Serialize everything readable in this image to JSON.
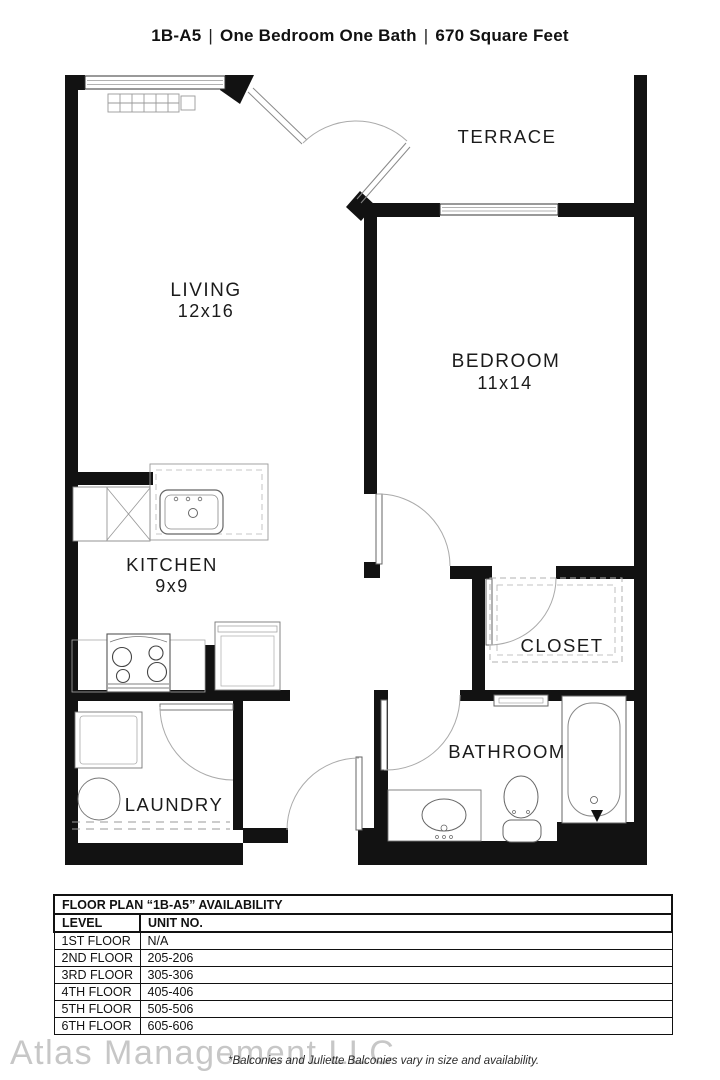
{
  "title": {
    "unit": "1B-A5",
    "separator": "|",
    "description": "One Bedroom One Bath",
    "area": "670 Square Feet"
  },
  "floorplan": {
    "rooms": {
      "living": {
        "label": "LIVING",
        "dims": "12x16"
      },
      "terrace": {
        "label": "TERRACE"
      },
      "bedroom": {
        "label": "BEDROOM",
        "dims": "11x14"
      },
      "kitchen": {
        "label": "KITCHEN",
        "dims": "9x9"
      },
      "closet": {
        "label": "CLOSET"
      },
      "bathroom": {
        "label": "BATHROOM"
      },
      "laundry": {
        "label": "LAUNDRY"
      }
    },
    "wall_color": "#121212",
    "fixture_line_color": "#777777"
  },
  "availability": {
    "table_title": "FLOOR PLAN “1B-A5” AVAILABILITY",
    "columns": {
      "level": "LEVEL",
      "unit": "UNIT NO."
    },
    "rows": [
      {
        "level": "1ST FLOOR",
        "unit": "N/A"
      },
      {
        "level": "2ND FLOOR",
        "unit": "205-206"
      },
      {
        "level": "3RD FLOOR",
        "unit": "305-306"
      },
      {
        "level": "4TH FLOOR",
        "unit": "405-406"
      },
      {
        "level": "5TH FLOOR",
        "unit": "505-506"
      },
      {
        "level": "6TH FLOOR",
        "unit": "605-606"
      }
    ]
  },
  "footer": {
    "watermark": "Atlas Management LLC",
    "note": "*Balconies and Juliette Balconies vary in size and availability."
  }
}
